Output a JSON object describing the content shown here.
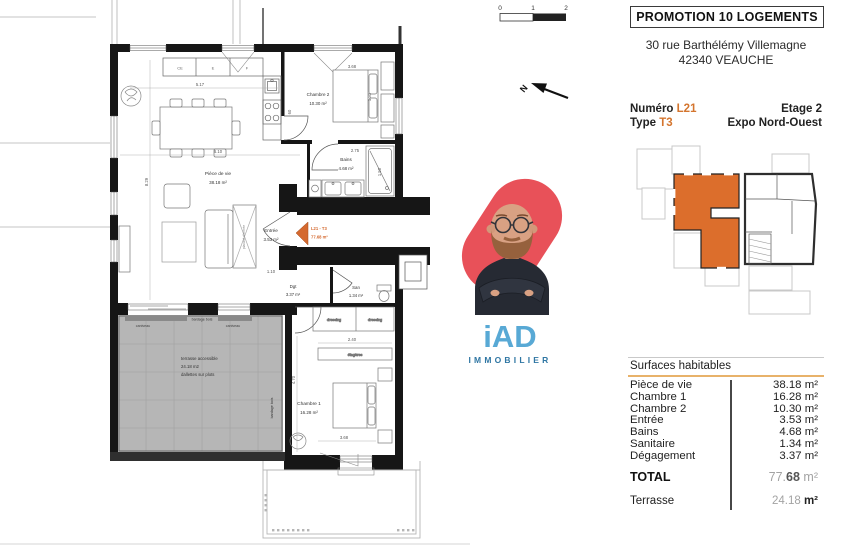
{
  "header": {
    "title": "PROMOTION 10 LOGEMENTS",
    "address_line1": "30 rue Barthélémy Villemagne",
    "address_line2": "42340 VEAUCHE"
  },
  "unit": {
    "numero_label": "Numéro",
    "numero_value": "L21",
    "type_label": "Type",
    "type_value": "T3",
    "etage": "Etage 2",
    "expo": "Expo Nord-Ouest",
    "accent_color": "#d4752e",
    "keyplan_highlight_color": "#dc6e2c"
  },
  "surfaces": {
    "title": "Surfaces habitables",
    "underline_color": "#e8b26a",
    "rows": [
      {
        "label": "Pièce de vie",
        "value": "38.18",
        "unit": "m²"
      },
      {
        "label": "Chambre 1",
        "value": "16.28",
        "unit": "m²"
      },
      {
        "label": "Chambre 2",
        "value": "10.30",
        "unit": "m²"
      },
      {
        "label": "Entrée",
        "value": "3.53",
        "unit": "m²"
      },
      {
        "label": "Bains",
        "value": "4.68",
        "unit": "m²"
      },
      {
        "label": "Sanitaire",
        "value": "1.34",
        "unit": "m²"
      },
      {
        "label": "Dégagement",
        "value": "3.37",
        "unit": "m²"
      }
    ],
    "total": {
      "label": "TOTAL",
      "value_a": "77.",
      "value_b": "68",
      "unit": "m²"
    },
    "terrasse": {
      "label": "Terrasse",
      "value": "24.18",
      "unit": "m²"
    }
  },
  "brand": {
    "logo": "iAD",
    "tagline": "IMMOBILIER",
    "logo_color": "#58a9d5",
    "tagline_color": "#2f76a3",
    "blob_color": "#e85159"
  },
  "plan": {
    "scale": {
      "t0": "0",
      "t1": "1",
      "t2": "2"
    },
    "north_label": "N",
    "rooms": {
      "piece_de_vie": {
        "name": "Pièce de vie",
        "area": "38.18 m²"
      },
      "chambre2": {
        "name": "Chambre 2",
        "area": "10.30 m²"
      },
      "bains": {
        "name": "Bains",
        "area": "4.68 m²"
      },
      "entree": {
        "name": "Entrée",
        "area": "3.53 m²"
      },
      "dgt": {
        "name": "Dgt",
        "area": "3.37 m²"
      },
      "san": {
        "name": "San",
        "area": "1.34 m²"
      },
      "chambre1": {
        "name": "Chambre 1",
        "area": "16.28 m²"
      }
    },
    "unit_tag": {
      "line1": "L21 - T3",
      "line2": "77.68 m²"
    },
    "terrace_note": [
      "terrasse accessible",
      "24.18 m2",
      "dallettes sur plots"
    ],
    "annotations": {
      "etageres": "étagères",
      "dressing1": "dressing",
      "dressing2": "dressing",
      "placard": "placard d'entrée",
      "bardage_top": "bardage bois",
      "bardage_side": "bardage bois",
      "caniveau1": "caniveau",
      "caniveau2": "caniveau"
    },
    "kitchen_units": [
      "CE",
      "E",
      "F"
    ],
    "dims": {
      "kitchen_w": "5.17",
      "living_w": "6.10",
      "living_h": "8.29",
      "ch2_w": "3.68",
      "ch2_d": "1.80",
      "bains_w": "2.75",
      "shower_h": "1.50",
      "dressing_w": "2.40",
      "ch1_h": "4.70",
      "ch1_w": "3.68",
      "entry_w": "1.10",
      "pass": "60"
    }
  }
}
